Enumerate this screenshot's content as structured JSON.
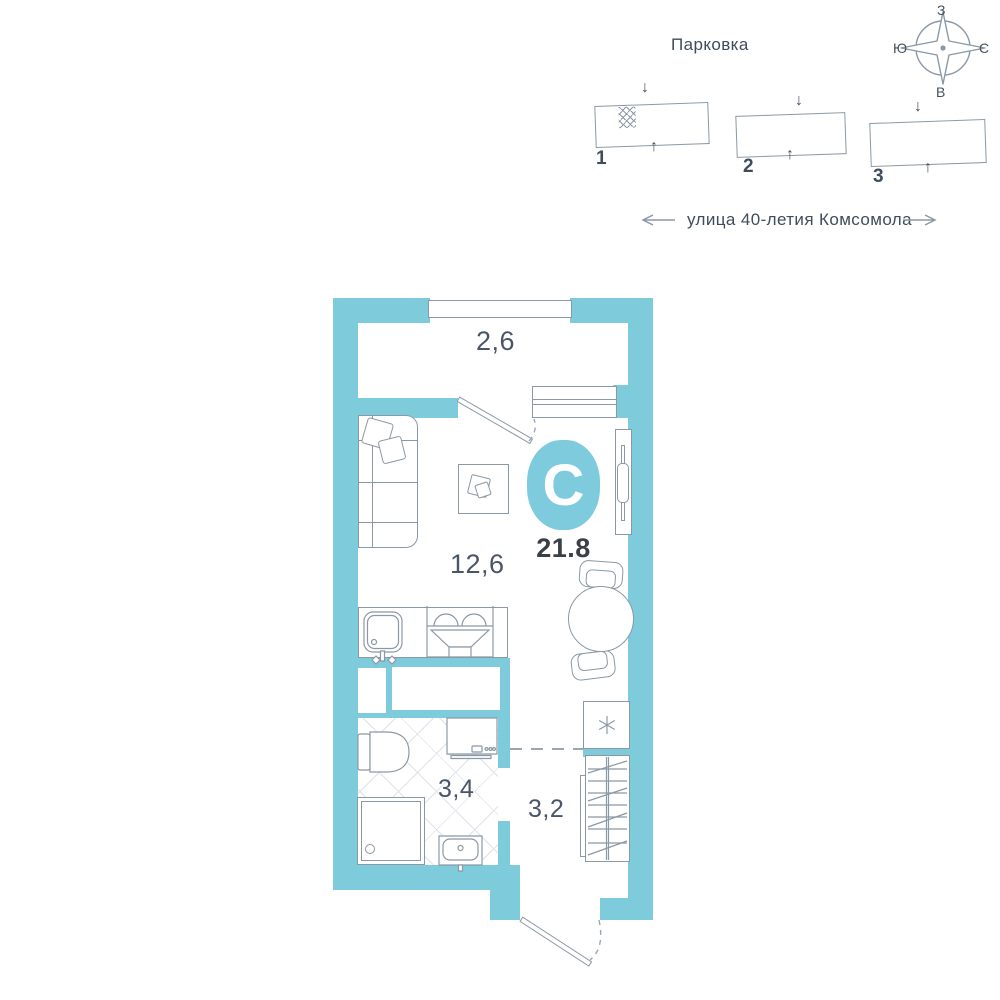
{
  "parking": {
    "title": "Парковка",
    "blocks": [
      {
        "number": "1"
      },
      {
        "number": "2"
      },
      {
        "number": "3"
      }
    ],
    "down_arrow": "↓",
    "up_arrow": "↑"
  },
  "street": {
    "name": "улица 40-летия Комсомола"
  },
  "compass": {
    "top": "З",
    "left": "Ю",
    "right": "С",
    "bottom": "В"
  },
  "plan": {
    "logo_letter": "C",
    "total_area": "21.8",
    "areas": {
      "balcony": "2,6",
      "living": "12,6",
      "bathroom": "3,4",
      "hallway": "3,2"
    }
  },
  "colors": {
    "wall": "#7ECBDC",
    "outline": "#8B99A6",
    "ink": "#445260",
    "logo": "#7FCBDE"
  }
}
